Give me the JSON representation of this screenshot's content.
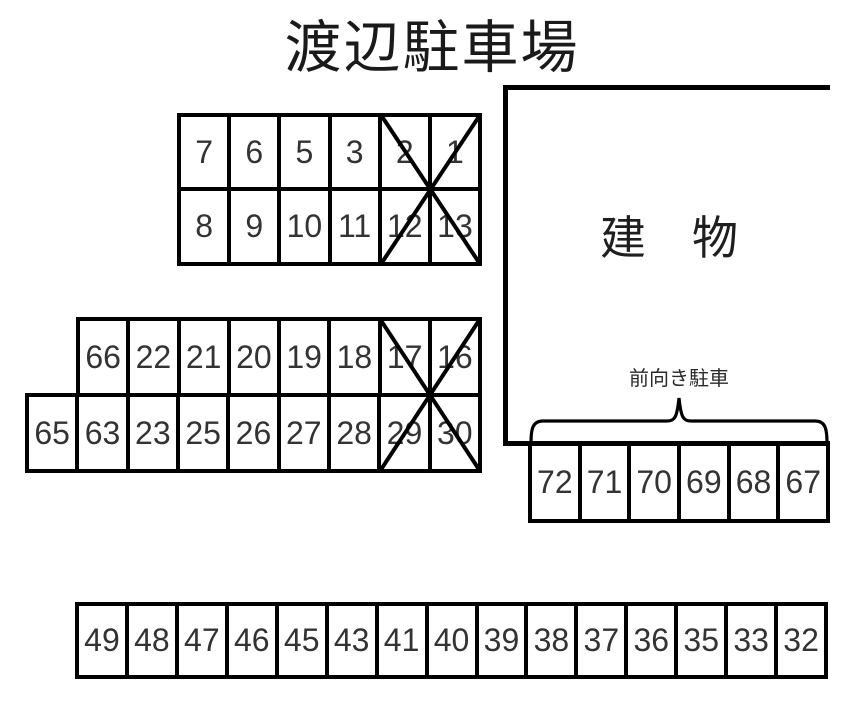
{
  "title": "渡辺駐車場",
  "building": {
    "label": "建　物"
  },
  "front_parking": {
    "label": "前向き駐車"
  },
  "lots": {
    "a": {
      "row1": [
        "7",
        "6",
        "5",
        "3",
        "2",
        "1"
      ],
      "row2": [
        "8",
        "9",
        "10",
        "11",
        "12",
        "13"
      ],
      "crossed_out": [
        "2",
        "1",
        "12",
        "13"
      ]
    },
    "b": {
      "row1": [
        "66",
        "22",
        "21",
        "20",
        "19",
        "18",
        "17",
        "16"
      ],
      "row2": [
        "65",
        "63",
        "23",
        "25",
        "26",
        "27",
        "28",
        "29",
        "30"
      ],
      "crossed_out": [
        "17",
        "16",
        "29",
        "30"
      ]
    },
    "c": {
      "row": [
        "72",
        "71",
        "70",
        "69",
        "68",
        "67"
      ]
    },
    "d": {
      "row": [
        "49",
        "48",
        "47",
        "46",
        "45",
        "43",
        "41",
        "40",
        "39",
        "38",
        "37",
        "36",
        "35",
        "33",
        "32"
      ]
    }
  },
  "colors": {
    "line": "#000000",
    "text": "#333333",
    "background": "#ffffff"
  }
}
